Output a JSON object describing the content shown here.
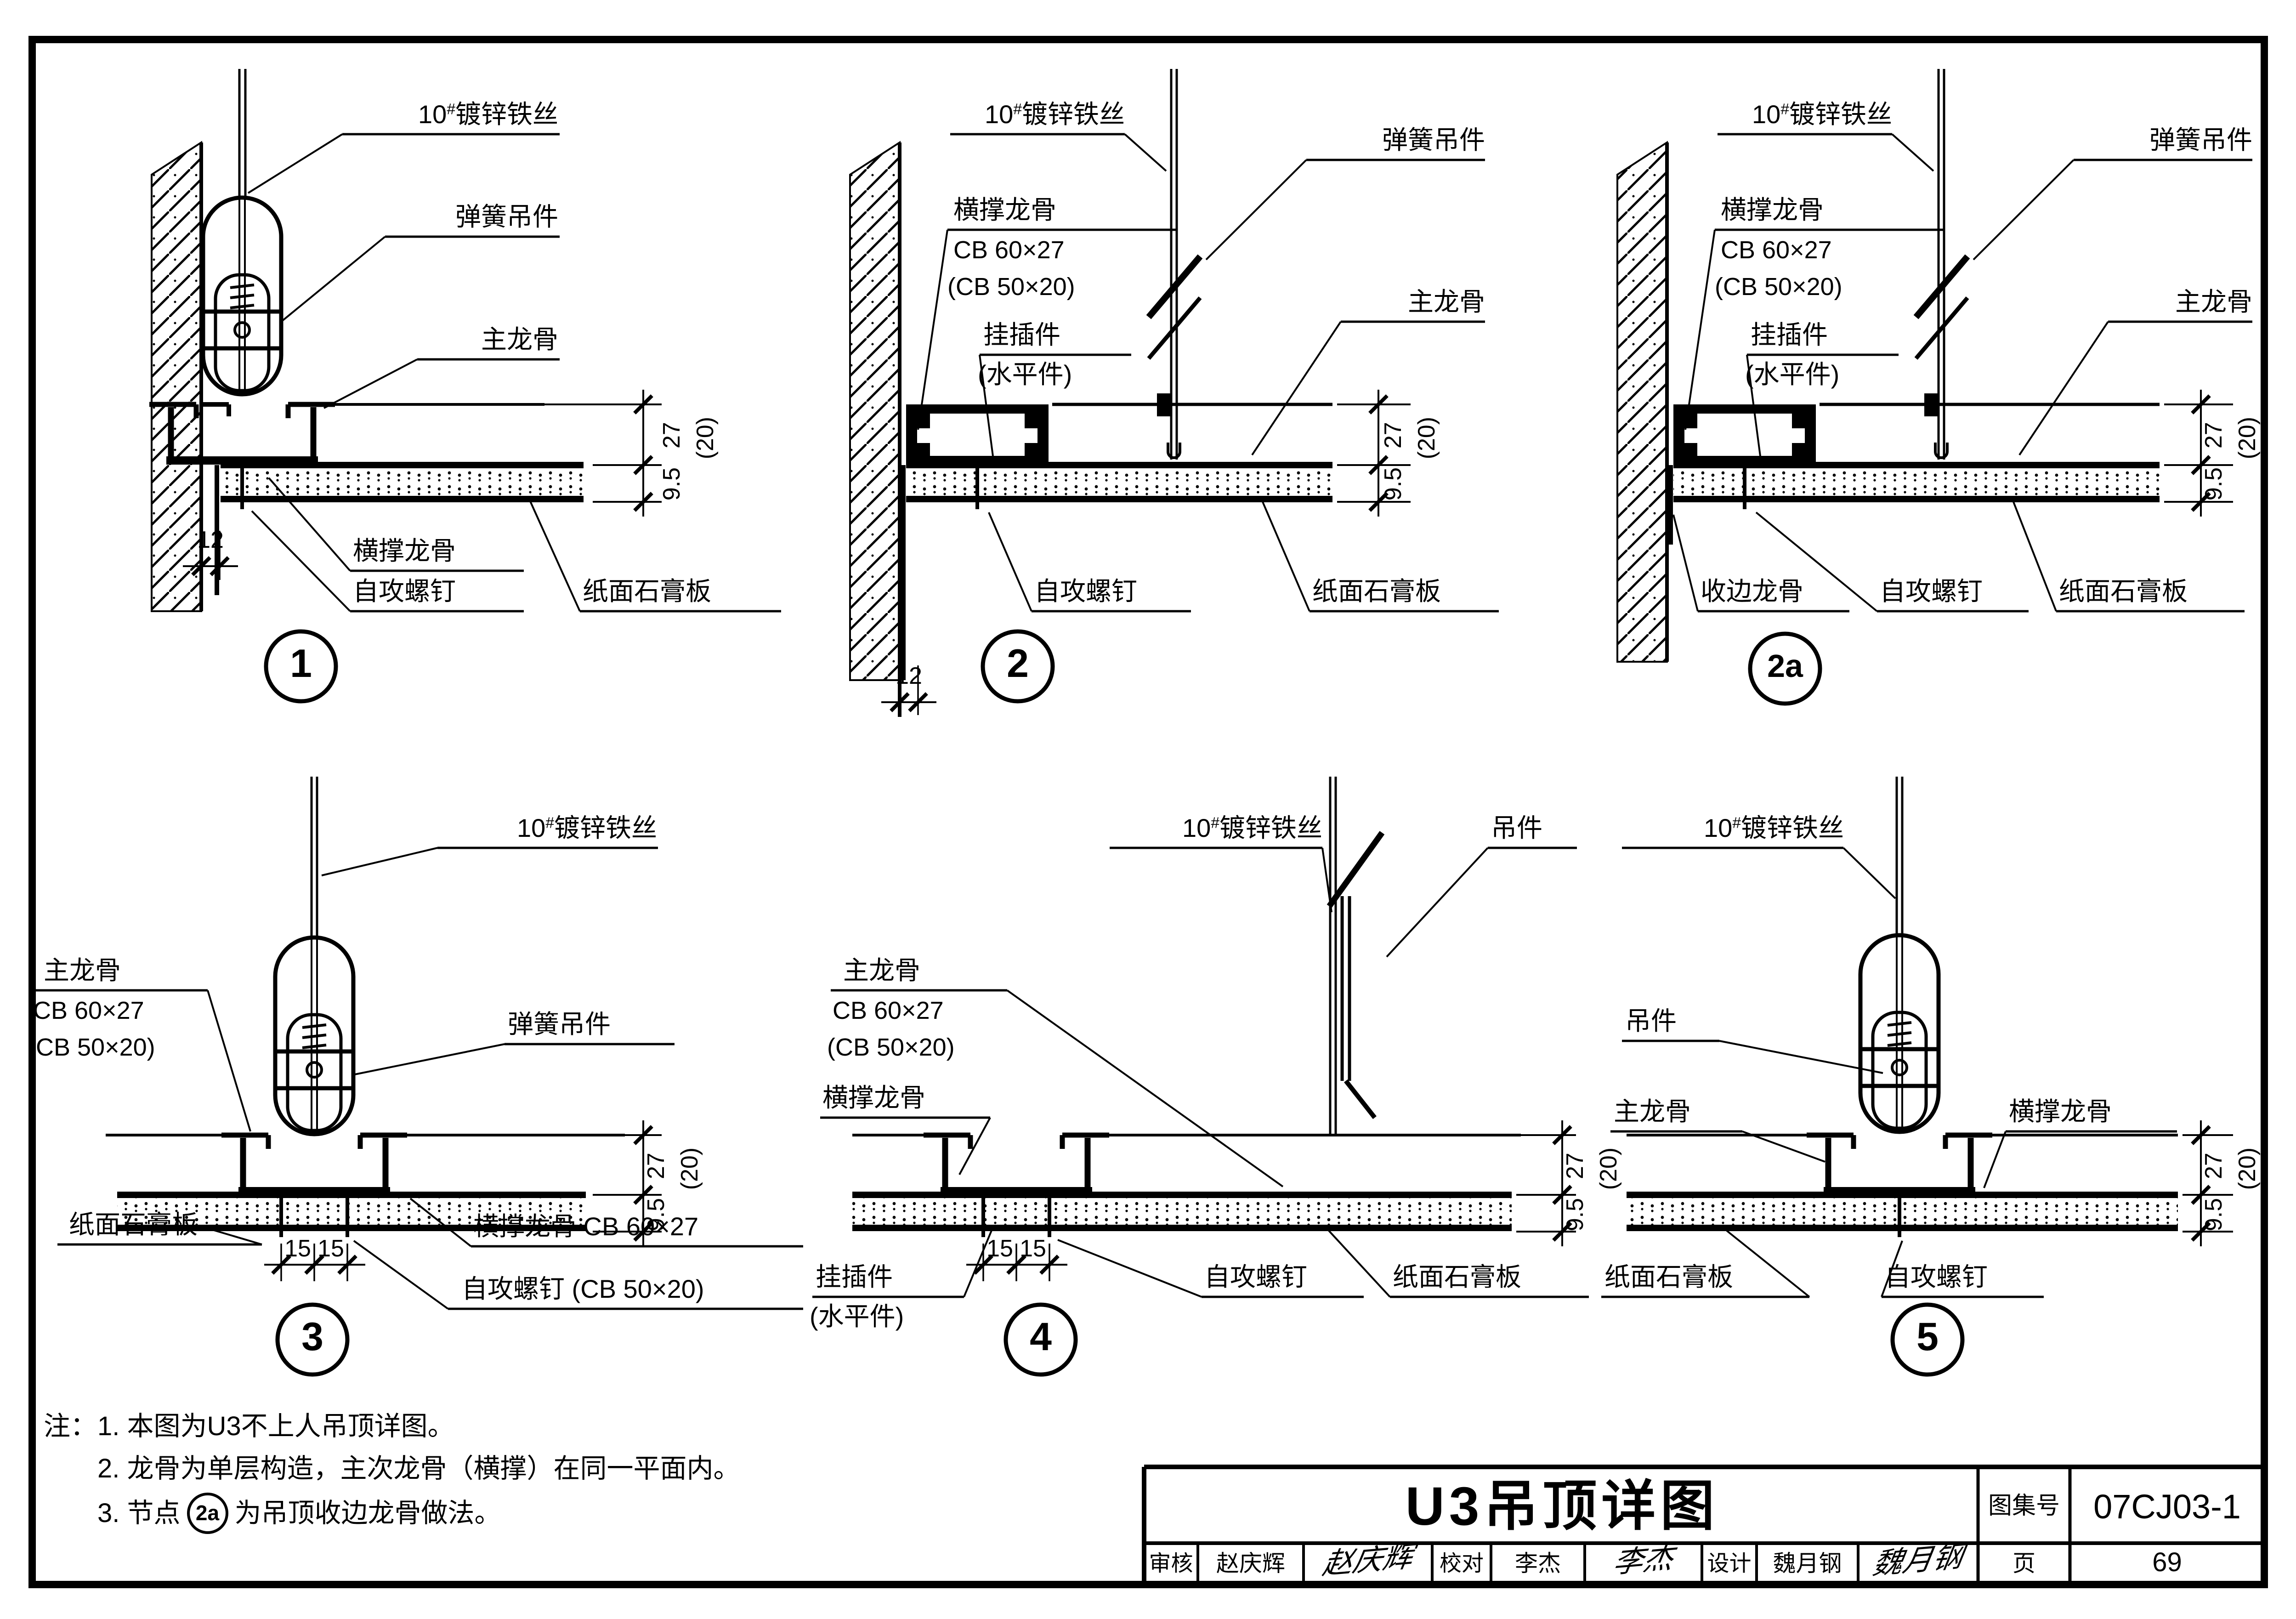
{
  "vocab": {
    "wire_pre": "10",
    "wire_sup": "#",
    "wire_post": "镀锌铁丝",
    "spring": "弹簧吊件",
    "main": "主龙骨",
    "cross": "横撑龙骨",
    "screw": "自攻螺钉",
    "board": "纸面石膏板",
    "hook1": "挂插件",
    "hook2": "(水平件)",
    "edge": "收边龙骨",
    "hanger": "吊件",
    "spec1": "CB 60×27",
    "spec2": "(CB 50×20)",
    "cross_spec": "横撑龙骨 CB 60×27",
    "screw_spec": "自攻螺钉 (CB 50×20)"
  },
  "dims": {
    "d27": "27",
    "d20": "(20)",
    "d95": "9.5",
    "d12": "12",
    "d15": "15"
  },
  "detail_numbers": {
    "d1": "1",
    "d2": "2",
    "d2a": "2a",
    "d3": "3",
    "d4": "4",
    "d5": "5"
  },
  "notes": {
    "prefix": "注：",
    "line1": "1. 本图为U3不上人吊顶详图。",
    "line2": "2. 龙骨为单层构造，主次龙骨（横撑）在同一平面内。",
    "line3_pre": "3. 节点",
    "line3_badge": "2a",
    "line3_post": "为吊顶收边龙骨做法。"
  },
  "title_block": {
    "title": "U3吊顶详图",
    "atlas_label": "图集号",
    "atlas_no": "07CJ03-1",
    "page_label": "页",
    "page_no": "69",
    "review_label": "审核",
    "review_name": "赵庆辉",
    "review_sig": "赵庆辉",
    "proof_label": "校对",
    "proof_name": "李杰",
    "proof_sig": "李杰",
    "design_label": "设计",
    "design_name": "魏月钢",
    "design_sig": "魏月钢"
  }
}
